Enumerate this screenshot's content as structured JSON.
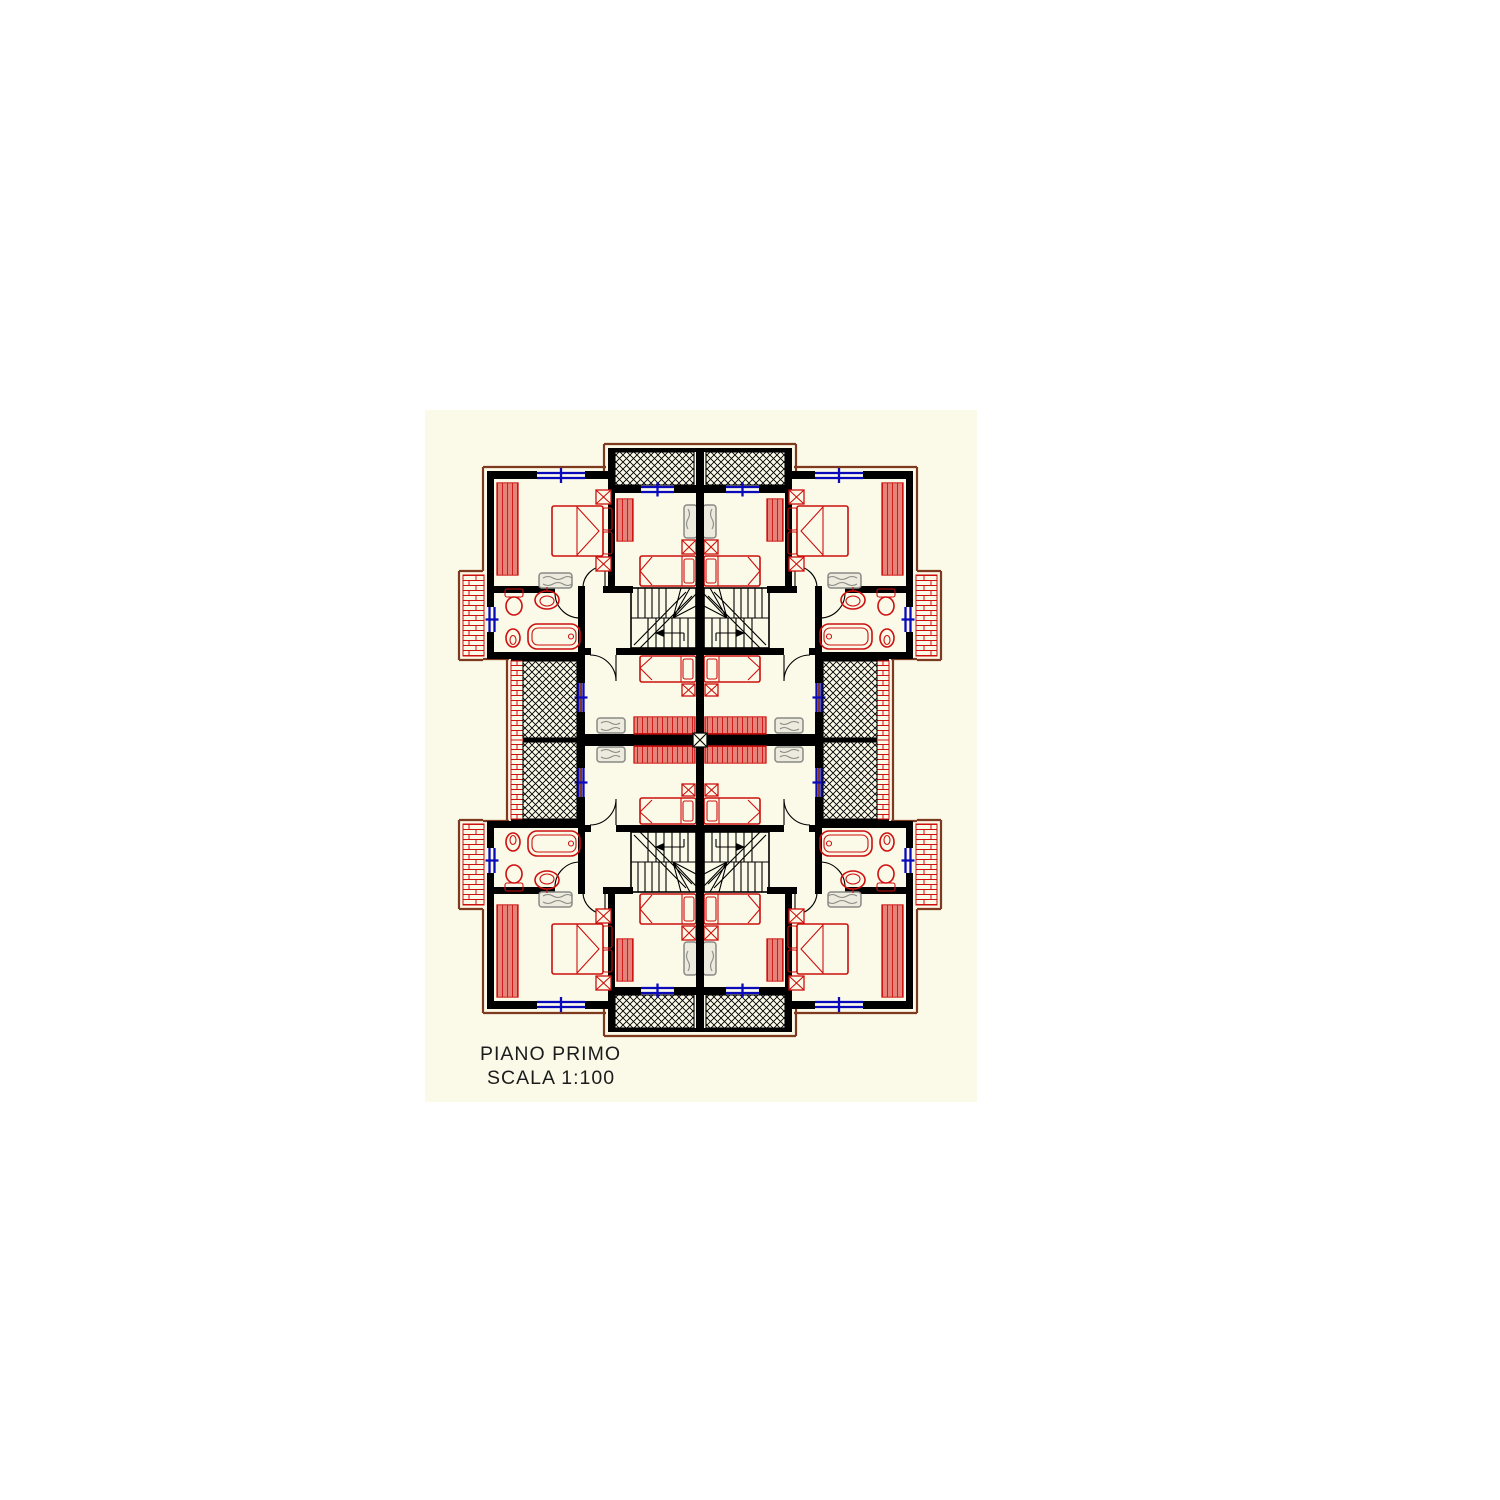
{
  "title_block": {
    "floor_label": "PIANO PRIMO",
    "scale_label": "SCALA 1:100"
  },
  "drawing": {
    "type": "architectural-floor-plan",
    "layout": "four mirrored apartment units around a central party wall",
    "visible_features": [
      "double-bed",
      "single-bed",
      "wardrobe",
      "nightstand",
      "dresser",
      "bathtub",
      "sink",
      "toilet",
      "bidet",
      "u-stairs",
      "door-swing",
      "window",
      "crosshatch-balcony",
      "brick-terrace"
    ]
  },
  "colors": {
    "page": "#ffffff",
    "canvas": "#fbf9e8",
    "wall": "#000000",
    "red": "#cd100e",
    "maroon": "#7e3a1e",
    "blue": "#0a0abb",
    "gray": "#8a8a86",
    "grayfill": "#edebdd",
    "text": "#1c1c1c"
  }
}
